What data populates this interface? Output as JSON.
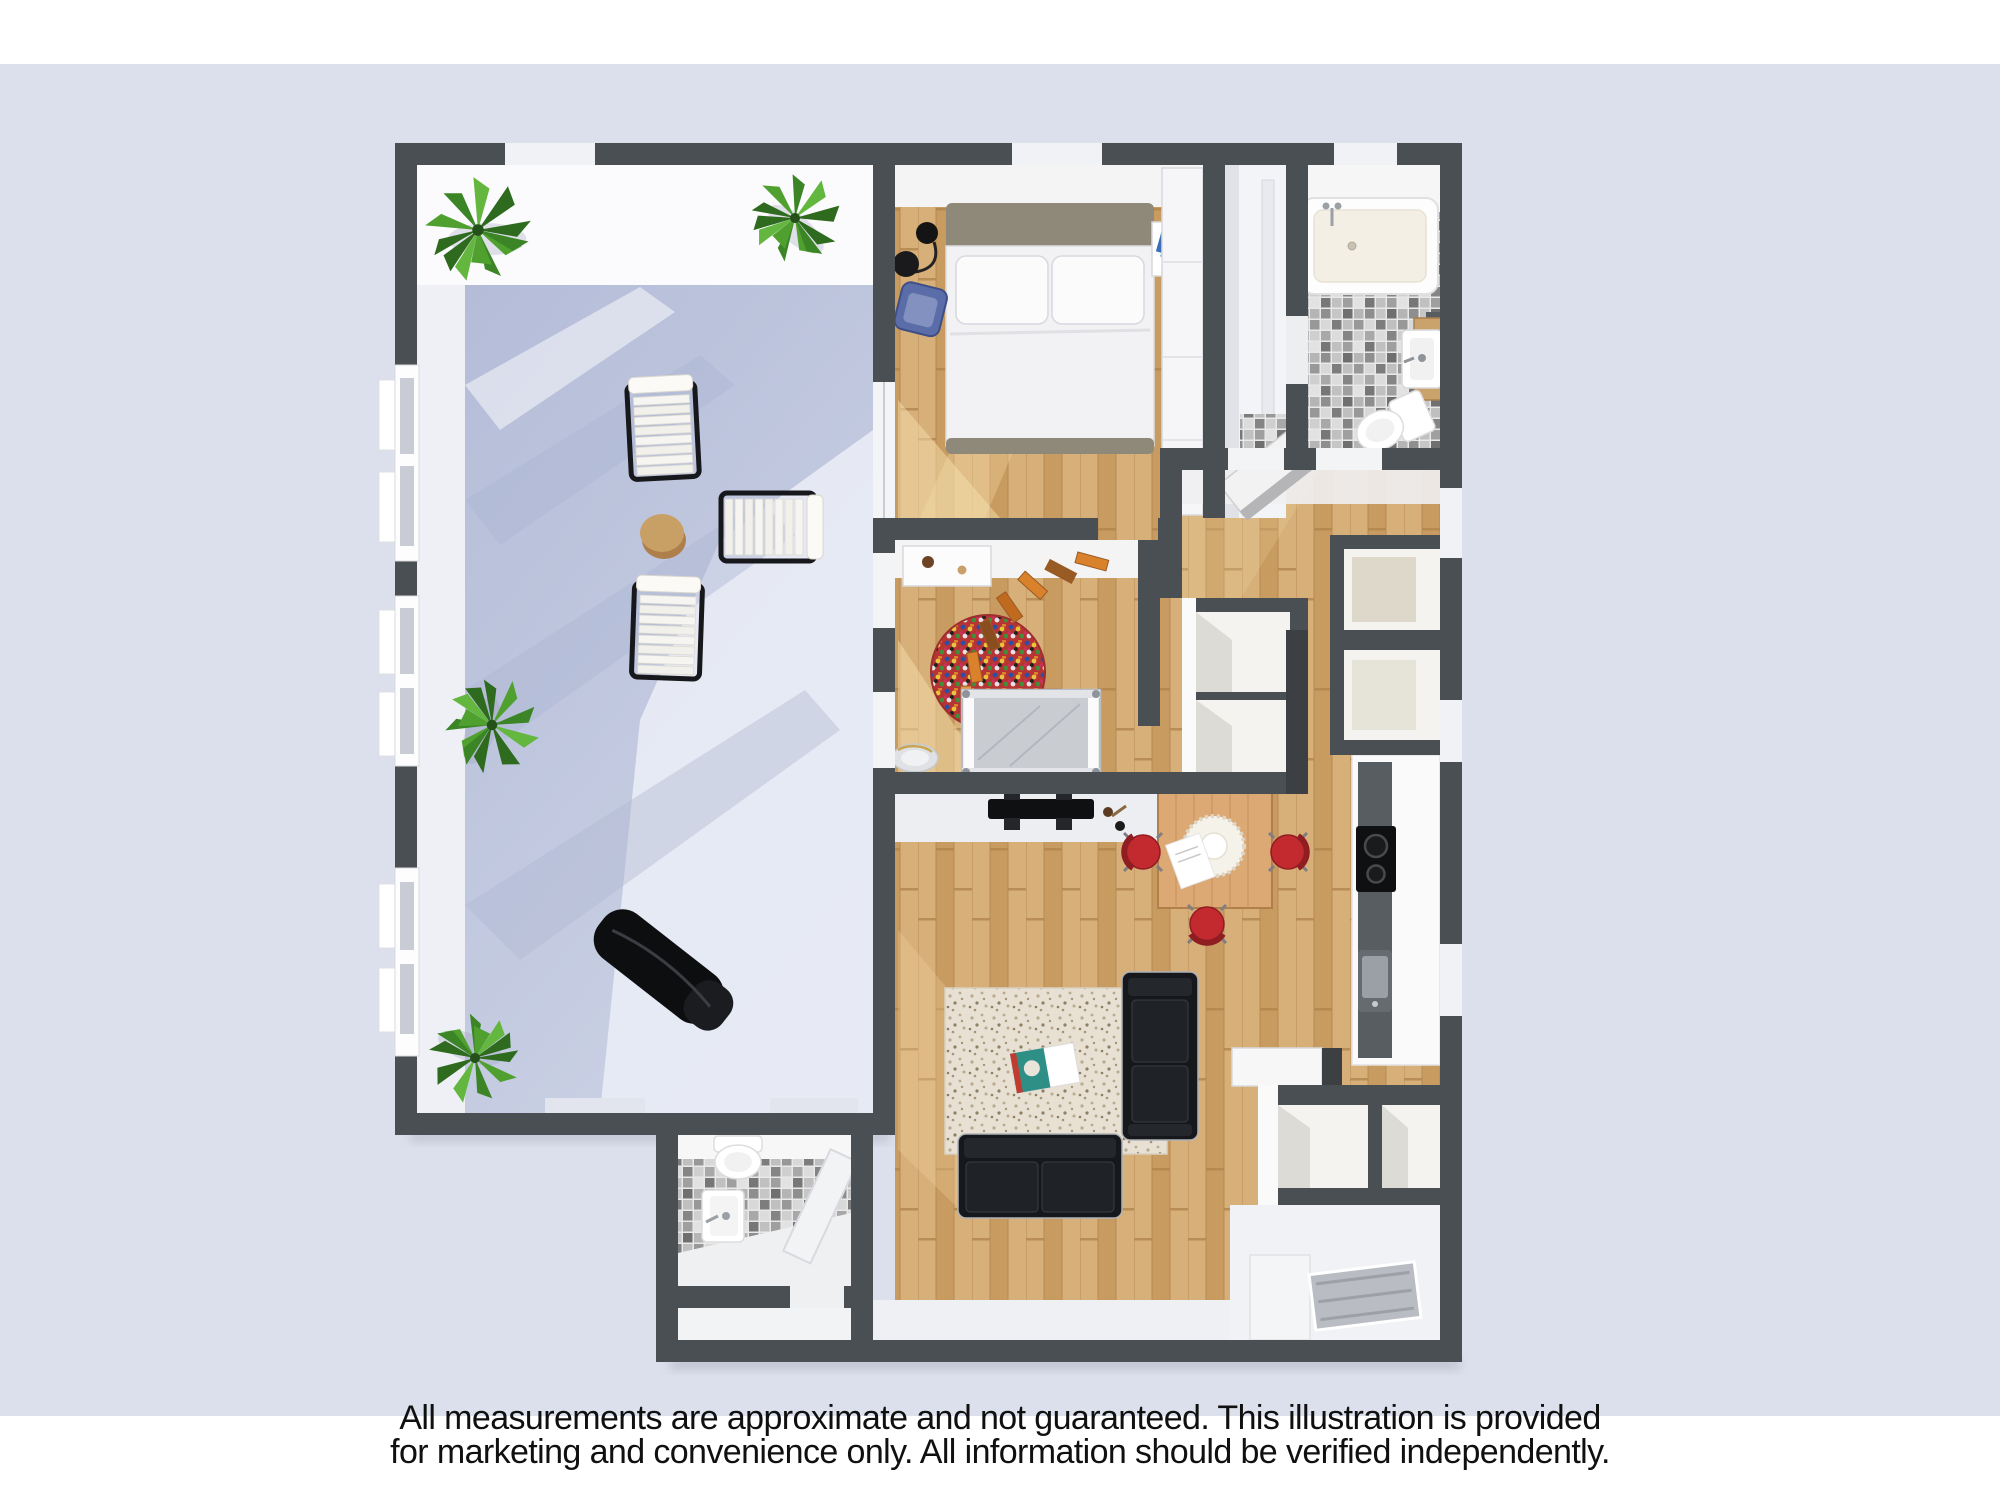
{
  "page": {
    "title": "3D apartment floor plan illustration",
    "background": "#dbe0ec",
    "top_band": "#ffffff",
    "bottom_band": "#ffffff"
  },
  "disclaimer": {
    "line1": "All measurements are approximate and not guaranteed. This illustration is provided",
    "line2": "for marketing and convenience only. All information should be verified independently.",
    "color": "#101010"
  },
  "palette": {
    "background": "#dbe0ec",
    "wall": "#4a4f53",
    "wall_dark": "#3f4346",
    "wood": "#cda269",
    "wood_light": "#d7af79",
    "wood_dark": "#c3945c",
    "wood_sunlit": "#f3d9a4",
    "terrace_floor": "#b6bed9",
    "terrace_sunlit": "#e8ebf4",
    "inner_wall_white": "#f4f4f5",
    "tile_grey": "#9a9a9a",
    "accent_red": "#c22a30",
    "sofa_black": "#17181b",
    "plant_green": "#49942c",
    "cork": "#c8a066",
    "crib_grey": "#c9ccd1",
    "rug_speckle_base": "#e7e0d3",
    "table_wood": "#dca874",
    "chair_blue": "#5a6da8",
    "headboard_taupe": "#8f897a"
  },
  "rooms": [
    {
      "name": "terrace"
    },
    {
      "name": "bedroom"
    },
    {
      "name": "walk-in-closet"
    },
    {
      "name": "bathroom"
    },
    {
      "name": "hallway"
    },
    {
      "name": "nursery"
    },
    {
      "name": "kitchen"
    },
    {
      "name": "dining-area"
    },
    {
      "name": "living-room"
    },
    {
      "name": "guest-bathroom"
    },
    {
      "name": "entry"
    }
  ],
  "furniture": [
    {
      "name": "potted-plant",
      "count": 4
    },
    {
      "name": "lounge-chair",
      "count": 3
    },
    {
      "name": "cork-side-table",
      "count": 1
    },
    {
      "name": "sun-lounger",
      "count": 1
    },
    {
      "name": "double-bed",
      "count": 1
    },
    {
      "name": "nightstand",
      "count": 1
    },
    {
      "name": "floor-lamp",
      "count": 1
    },
    {
      "name": "blue-armchair",
      "count": 1
    },
    {
      "name": "wardrobe",
      "count": 1
    },
    {
      "name": "bathtub",
      "count": 1
    },
    {
      "name": "bathroom-sink",
      "count": 2
    },
    {
      "name": "toilet",
      "count": 2
    },
    {
      "name": "mirror",
      "count": 1
    },
    {
      "name": "hall-desk",
      "count": 1
    },
    {
      "name": "changing-table",
      "count": 1
    },
    {
      "name": "toy-train-track",
      "count": 1
    },
    {
      "name": "confetti-round-rug",
      "count": 1
    },
    {
      "name": "crib",
      "count": 1
    },
    {
      "name": "pet-bed",
      "count": 1
    },
    {
      "name": "tv",
      "count": 1
    },
    {
      "name": "kitchen-counter",
      "count": 1
    },
    {
      "name": "cooktop",
      "count": 1
    },
    {
      "name": "kitchen-sink",
      "count": 1
    },
    {
      "name": "dining-table",
      "count": 1
    },
    {
      "name": "dining-chair",
      "count": 3
    },
    {
      "name": "leather-sofa",
      "count": 2
    },
    {
      "name": "shag-rug",
      "count": 1
    },
    {
      "name": "magazine",
      "count": 1
    },
    {
      "name": "closet-niche",
      "count": 6
    },
    {
      "name": "shower",
      "count": 1
    },
    {
      "name": "entrance-mat",
      "count": 1
    }
  ]
}
